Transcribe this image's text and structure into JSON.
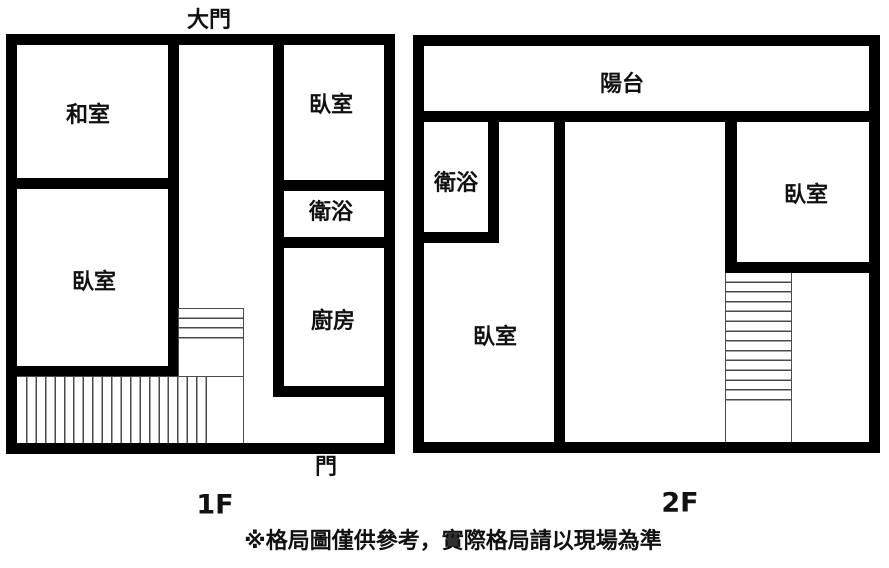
{
  "floor1": {
    "label": "1F",
    "entrance_top_label": "大門",
    "entrance_bottom_label": "門",
    "rooms": {
      "washitsu": "和室",
      "bedroom_left": "臥室",
      "bedroom_right": "臥室",
      "bathroom": "衛浴",
      "kitchen": "廚房"
    }
  },
  "floor2": {
    "label": "2F",
    "rooms": {
      "balcony": "陽台",
      "bathroom": "衛浴",
      "bedroom_left": "臥室",
      "bedroom_right": "臥室"
    }
  },
  "disclaimer": "※格局圖僅供參考，實際格局請以現場為準",
  "colors": {
    "wall": "#000000",
    "stair_line": "#4a4a4a",
    "background": "#ffffff",
    "text": "#111111"
  }
}
